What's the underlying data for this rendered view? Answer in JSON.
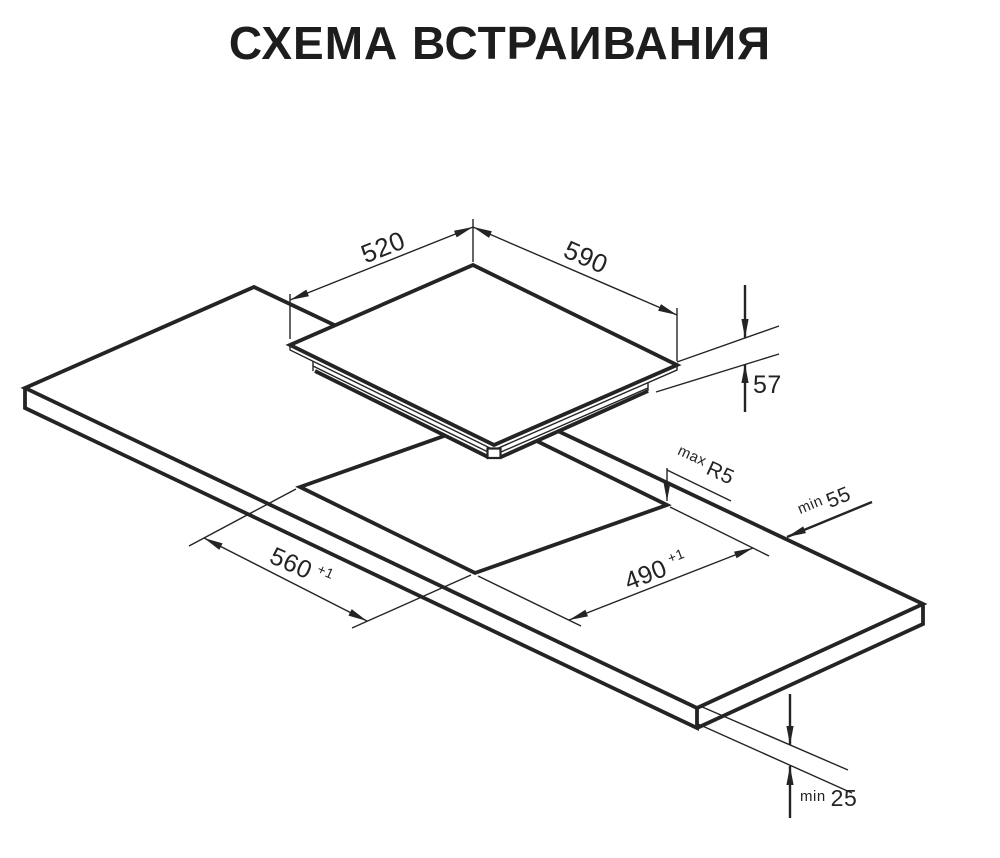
{
  "title": "СХЕМА ВСТРАИВАНИЯ",
  "diagram": {
    "description": "Isometric installation drawing: built-in hob lifted above a worktop with a rectangular mounting cutout",
    "colors": {
      "ink": "#242424",
      "background": "#ffffff"
    },
    "labels": {
      "hob_top_depth": "520",
      "hob_top_width": "590",
      "hob_body_height": "57",
      "cutout_corner_radius_qualifier": "max",
      "cutout_corner_radius": "R5",
      "rear_clearance_qualifier": "min",
      "rear_clearance": "55",
      "cutout_width": "560",
      "cutout_width_tolerance": "+1",
      "cutout_depth": "490",
      "cutout_depth_tolerance": "+1",
      "under_clearance_qualifier": "min",
      "under_clearance": "25"
    }
  }
}
